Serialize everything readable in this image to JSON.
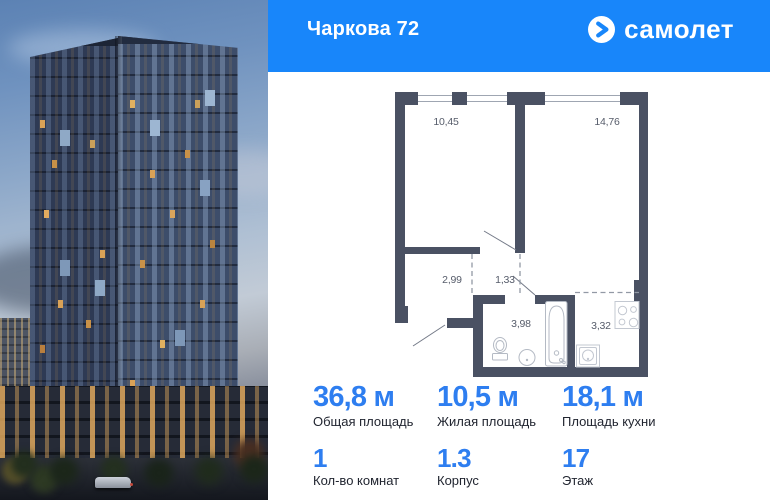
{
  "header": {
    "title": "Чаркова 72",
    "brand": "самолет",
    "logo_icon": "arrow-right-circle-icon"
  },
  "plan": {
    "rooms": [
      {
        "area": "10,45"
      },
      {
        "area": "14,76"
      },
      {
        "area": "2,99"
      },
      {
        "area": "1,33"
      },
      {
        "area": "3,98"
      },
      {
        "area": "3,32"
      }
    ],
    "fixtures": [
      "toilet",
      "sink",
      "bathtub",
      "stove",
      "kitchen-sink"
    ]
  },
  "stats": {
    "primary": [
      {
        "value": "36,8 м",
        "label": "Общая площадь"
      },
      {
        "value": "10,5 м",
        "label": "Жилая площадь"
      },
      {
        "value": "18,1 м",
        "label": "Площадь кухни"
      }
    ],
    "secondary": [
      {
        "value": "1",
        "label": "Кол-во комнат"
      },
      {
        "value": "1.3",
        "label": "Корпус"
      },
      {
        "value": "17",
        "label": "Этаж"
      }
    ]
  },
  "colors": {
    "brand_blue": "#1886fa",
    "value_blue": "#2e7ef0",
    "plan_wall": "#4a5163"
  }
}
